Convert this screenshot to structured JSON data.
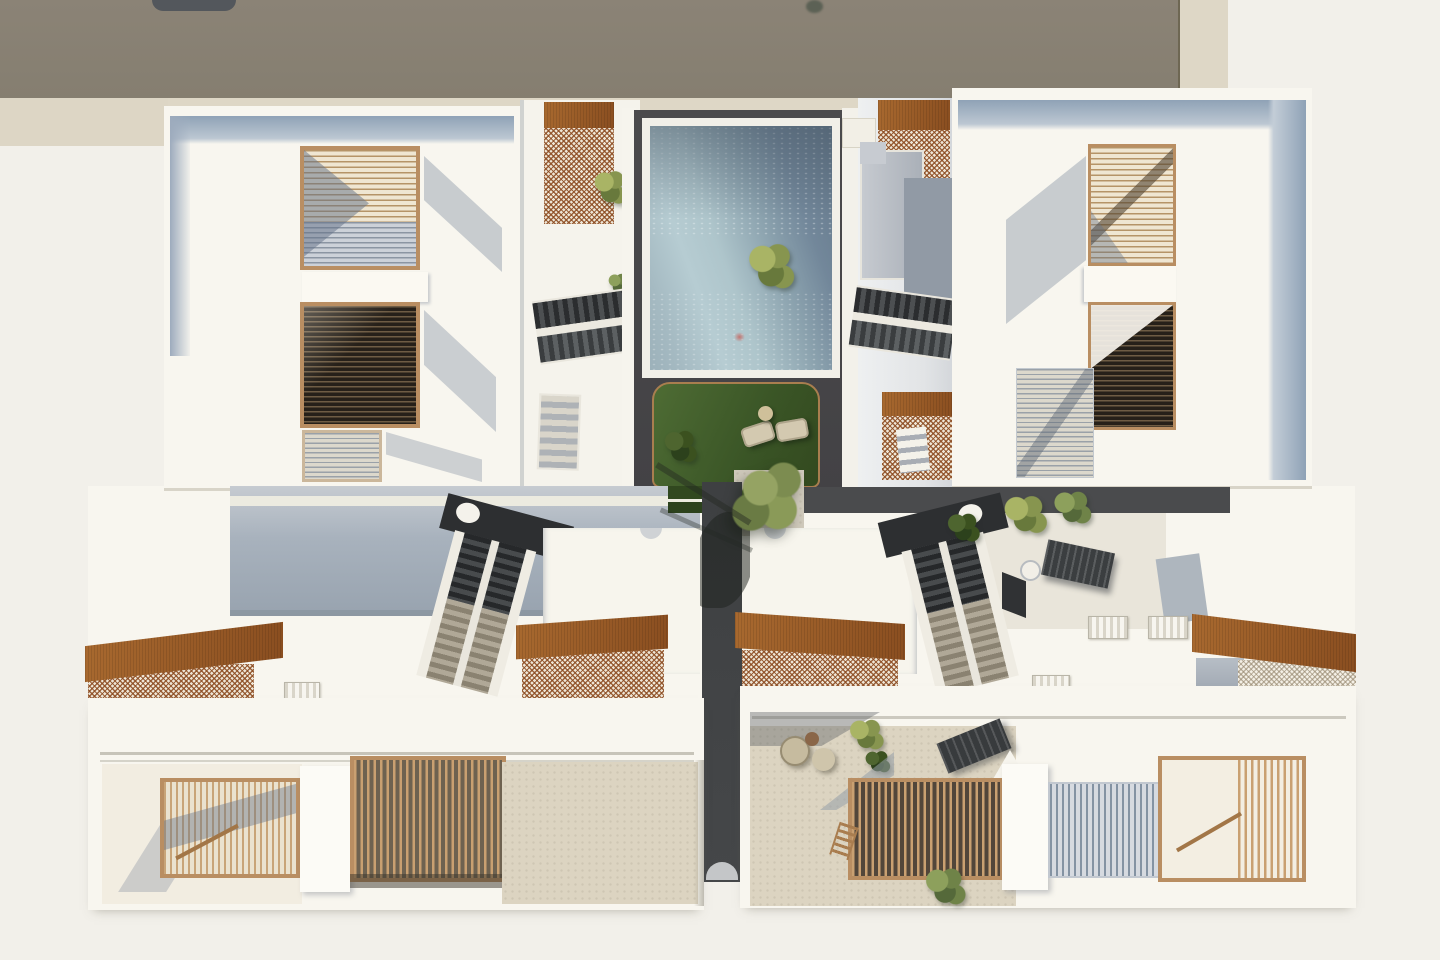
{
  "scene": {
    "type": "architectural-3d-render",
    "view": "top-down aerial plan view",
    "subject": "two-row residential apartment complex with central courtyard, swimming pool and roof terraces",
    "lighting": "daytime sun from upper right, shadows cast to lower left",
    "text_content": "none (image contains no text)",
    "objects": [
      {
        "name": "neighbor-building-roof",
        "desc": "flat taupe roof of adjacent building along the top edge with two dark rooftop vents"
      },
      {
        "name": "swimming-pool",
        "desc": "rectangular pool, rippled blue-gray water, white coping, set in dark anthracite deck"
      },
      {
        "name": "courtyard-lawn",
        "desc": "sunken green lawn with two cream lounge chairs, round side table and shrubs"
      },
      {
        "name": "courtyard-tree",
        "desc": "olive-green tree over paved square casting shadow across the walkway"
      },
      {
        "name": "central-walkway",
        "desc": "dark paved spine running south from the courtyard between the building rows"
      },
      {
        "name": "outdoor-stairs",
        "desc": "four external stair runs: two beside the pool, two diagonal double-flight runs in the middle band with dark and beige treads and white stringers"
      },
      {
        "name": "corten-pergolas",
        "desc": "eight rust-brown perforated corten steel canopies over entries and terraces"
      },
      {
        "name": "timber-louver-screens",
        "desc": "tan wood slatted privacy screens over balconies of the two upper buildings"
      },
      {
        "name": "roof-terraces",
        "desc": "four lower roof terraces with vertical timber slat railings, gray slat railings, stone-beige floors"
      },
      {
        "name": "terrace-furniture",
        "desc": "wicker chairs, pouf, round wood table, dark sun loungers, white bistro table"
      },
      {
        "name": "skylights",
        "desc": "small ridged skylight boxes on the lower roofs"
      }
    ]
  },
  "palette": {
    "bg": "#f2f0ea",
    "neighbor_roof": "#8b8376",
    "sand": "#ded7c6",
    "roof_white": "#f8f6ef",
    "parapet_blue": "#8fa2b6",
    "parapet_blue_light": "#bcc7d2",
    "facade_shade": "#a8b2bd",
    "wood_frame": "#b98e62",
    "slat_cream": "#efe6d2",
    "slat_line": "#b59468",
    "slat_dark": "#262019",
    "slat_gray": "#ccd1d8",
    "corten": "#96552a",
    "corten_light": "#a8692f",
    "corten_dark": "#8a4e20",
    "water_light": "#b6ccd2",
    "water_dark": "#64788a",
    "deck_dark": "#4a494b",
    "timber_curb": "#a97e4f",
    "grass": "#3a5526",
    "grass_dark": "#2c421d",
    "foliage": "#8a9a58",
    "walkway": "#3e4042",
    "stair_dark": "#26282a",
    "stair_beige": "#b0a897",
    "terrace_beige": "#dcd4c1",
    "terrace_light": "#e9e5da",
    "furniture_dark": "#3b3e40",
    "furniture_cream": "#d3c9b0"
  }
}
